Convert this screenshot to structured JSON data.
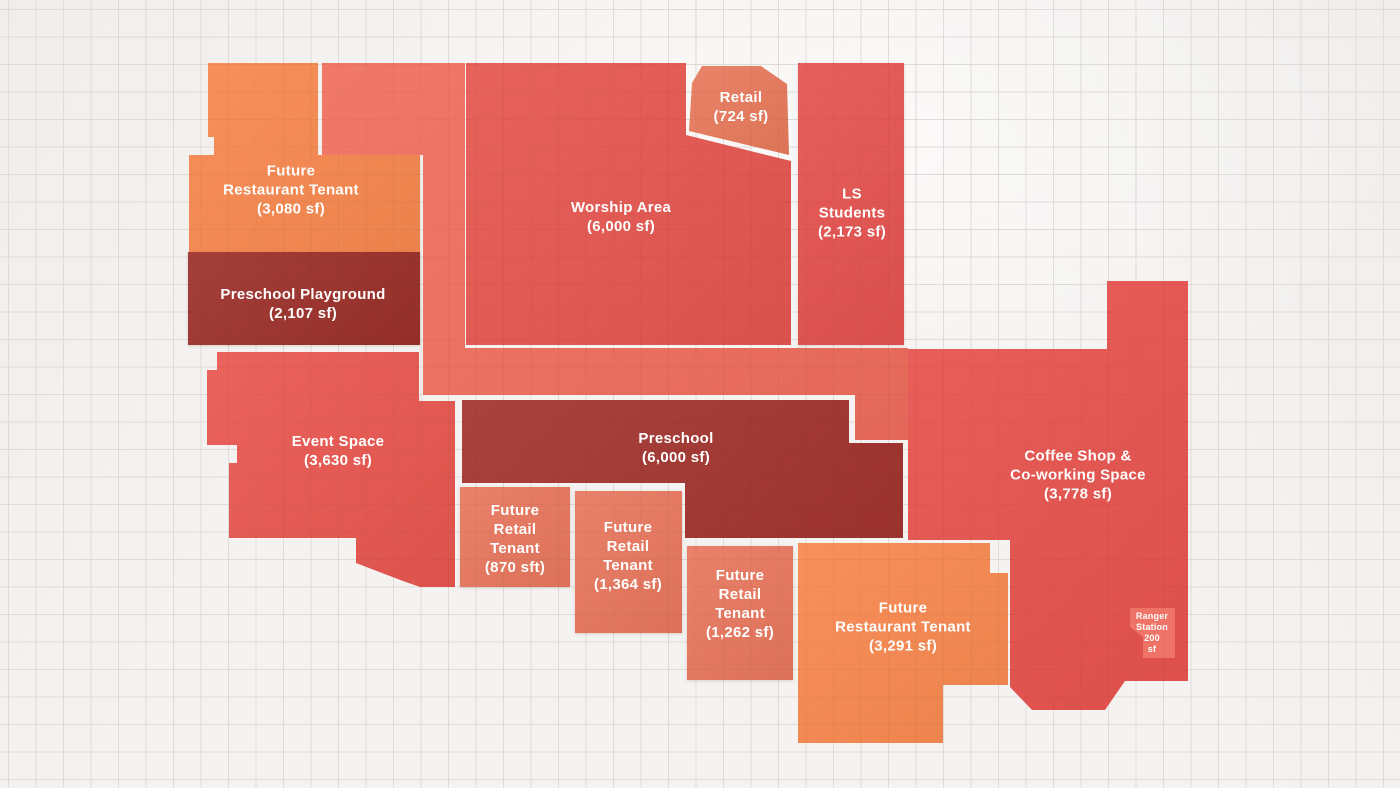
{
  "floorplan": {
    "background": {
      "paper": "#f5f3f1",
      "grid_line": "#e6e4e2"
    },
    "zones": [
      {
        "id": "future-restaurant-north",
        "name": "Future Restaurant Tenant",
        "area": "3,080 sf",
        "color": "#F8884F",
        "lines": [
          "Future",
          "Restaurant Tenant",
          "(3,080 sf)"
        ]
      },
      {
        "id": "corridor",
        "color": "#F06E5E",
        "lines": []
      },
      {
        "id": "worship-area",
        "name": "Worship Area",
        "area": "6,000 sf",
        "color": "#E65650",
        "lines": [
          "Worship Area",
          "(6,000 sf)"
        ]
      },
      {
        "id": "retail",
        "name": "Retail",
        "area": "724 sf",
        "color": "#E87A5C",
        "lines": [
          "Retail",
          "(724 sf)"
        ]
      },
      {
        "id": "ls-students",
        "name": "LS Students",
        "area": "2,173 sf",
        "color": "#E55350",
        "lines": [
          "LS",
          "Students",
          "(2,173 sf)"
        ]
      },
      {
        "id": "preschool-playground",
        "name": "Preschool Playground",
        "area": "2,107 sf",
        "color": "#9C302B",
        "lines": [
          "Preschool Playground",
          "(2,107 sf)"
        ]
      },
      {
        "id": "event-space",
        "name": "Event Space",
        "area": "3,630 sf",
        "color": "#E95750",
        "lines": [
          "Event Space",
          "(3,630 sf)"
        ]
      },
      {
        "id": "preschool",
        "name": "Preschool",
        "area": "6,000 sf",
        "color": "#A3342F",
        "lines": [
          "Preschool",
          "(6,000 sf)"
        ]
      },
      {
        "id": "future-retail-870",
        "name": "Future Retail Tenant",
        "area": "870 sft",
        "color": "#E8775E",
        "lines": [
          "Future",
          "Retail",
          "Tenant",
          "(870 sft)"
        ]
      },
      {
        "id": "future-retail-1364",
        "name": "Future Retail Tenant",
        "area": "1,364 sf",
        "color": "#E8775E",
        "lines": [
          "Future",
          "Retail",
          "Tenant",
          "(1,364 sf)"
        ]
      },
      {
        "id": "future-retail-1262",
        "name": "Future Retail Tenant",
        "area": "1,262 sf",
        "color": "#E8775E",
        "lines": [
          "Future",
          "Retail",
          "Tenant",
          "(1,262 sf)"
        ]
      },
      {
        "id": "future-restaurant-south",
        "name": "Future Restaurant Tenant",
        "area": "3,291 sf",
        "color": "#F8884F",
        "lines": [
          "Future",
          "Restaurant Tenant",
          "(3,291 sf)"
        ]
      },
      {
        "id": "coffee-coworking",
        "name": "Coffee Shop & Co-working Space",
        "area": "3,778 sf",
        "color": "#E8534E",
        "lines": [
          "Coffee Shop &",
          "Co-working Space",
          "(3,778 sf)"
        ]
      },
      {
        "id": "ranger-station",
        "name": "Ranger Station",
        "area": "200 sf",
        "color": "#EF7366",
        "lines": [
          "Ranger",
          "Station",
          "200",
          "sf"
        ]
      }
    ]
  }
}
